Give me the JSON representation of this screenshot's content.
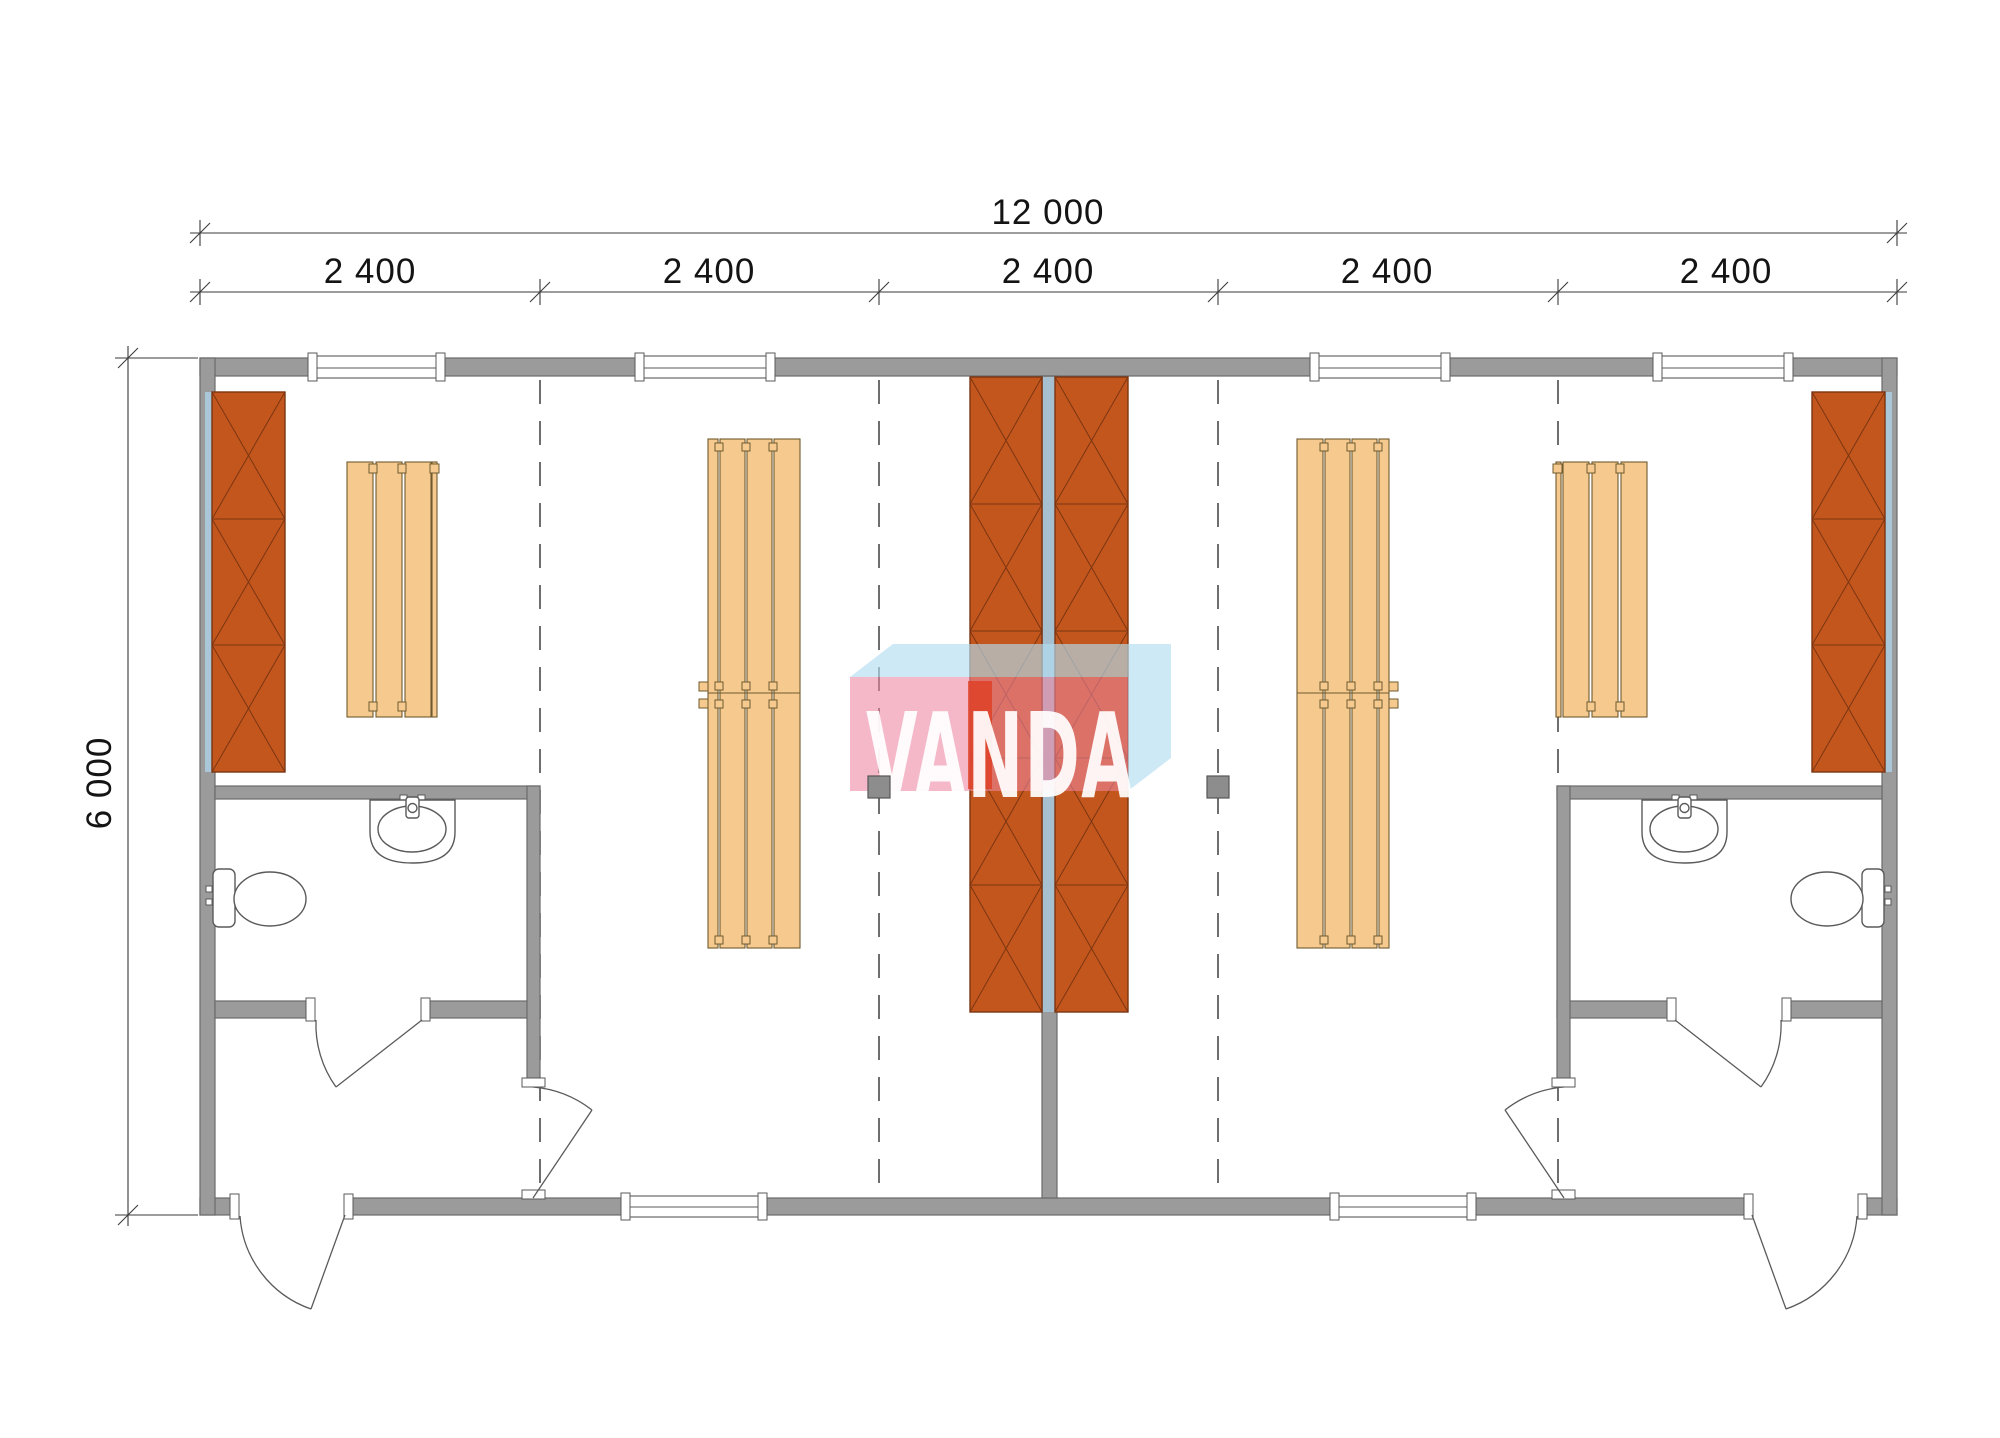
{
  "watermark": {
    "text": "VANDA"
  },
  "dimensions": {
    "overall_width": "12 000",
    "height": "6 000",
    "bays": [
      "2 400",
      "2 400",
      "2 400",
      "2 400",
      "2 400"
    ]
  },
  "colors": {
    "wall": "#9b9b9b",
    "wall_line": "#6a6a6a",
    "locker": "#c3561c",
    "locker_line": "#7b3512",
    "bench": "#f6ca8e",
    "bench_line": "#6f5a2e",
    "liner": "#a9c7d9",
    "dash": "#3f3f3f",
    "dim": "#3a3a3a",
    "fixture": "#5a5a5a",
    "post": "#8d8d8d",
    "logo_pink": "#ee85a0",
    "logo_blue": "#b2ddf1",
    "logo_red": "#e0391b"
  },
  "plan_summary": {
    "units": 2,
    "grid_lines": 4,
    "top_windows": 4,
    "bottom_windows": 2,
    "exterior_doors": 2,
    "interior_doors": 4,
    "wall_locker_panels": 2,
    "central_locker_columns": 2,
    "long_benches": 2,
    "short_benches": 2,
    "toilets": 2,
    "sinks": 2,
    "posts": 2
  }
}
